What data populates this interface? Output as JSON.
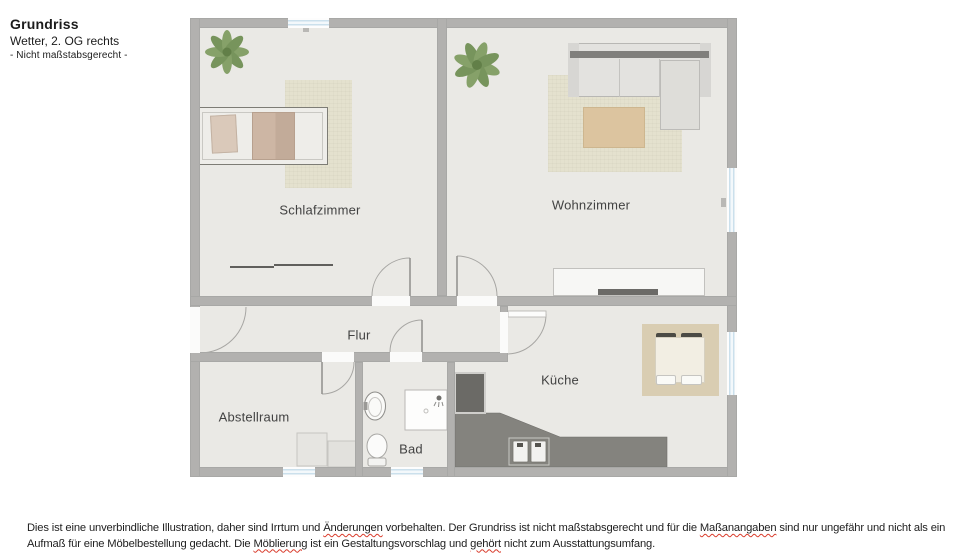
{
  "title_block": {
    "title": "Grundriss",
    "subtitle": "Wetter, 2. OG rechts",
    "note": "- Nicht maßstabsgerecht -"
  },
  "floorplan": {
    "rooms": [
      {
        "name": "Schlafzimmer"
      },
      {
        "name": "Wohnzimmer"
      },
      {
        "name": "Flur"
      },
      {
        "name": "Abstellraum"
      },
      {
        "name": "Bad"
      },
      {
        "name": "Küche"
      }
    ]
  },
  "footer": {
    "lines": [
      {
        "parts": [
          {
            "text": "Dies ist eine unverbindliche Illustration, daher sind Irrtum und ",
            "misspelled": false
          },
          {
            "text": "Änderungen",
            "misspelled": true
          },
          {
            "text": " vorbehalten. Der Grundriss ist nicht maßstabsgerecht und für die ",
            "misspelled": false
          },
          {
            "text": "Maßanangaben",
            "misspelled": true
          },
          {
            "text": " sind nur ungefähr und nicht als ein",
            "misspelled": false
          }
        ]
      },
      {
        "parts": [
          {
            "text": "Aufmaß für eine Möbelbestellung gedacht. Die ",
            "misspelled": false
          },
          {
            "text": "Möblierung",
            "misspelled": true
          },
          {
            "text": " ist ein Gestaltungsvorschlag und ",
            "misspelled": false
          },
          {
            "text": "gehört",
            "misspelled": true
          },
          {
            "text": " nicht zum Ausstattungsumfang.",
            "misspelled": false
          }
        ]
      }
    ]
  },
  "colors": {
    "wall": "#b2b1af",
    "floor": "#eae9e5",
    "rug": "#e4e1ce",
    "rug-dining": "#d9cdb2",
    "wood": "#dcc49f",
    "counter": "#84837e",
    "appliance": "#6b6a66",
    "plant": "#7e9b5f",
    "plant-dark": "#6e8d51",
    "window-glass": "#cbe0ec",
    "spellcheck": "#d93b2b"
  }
}
